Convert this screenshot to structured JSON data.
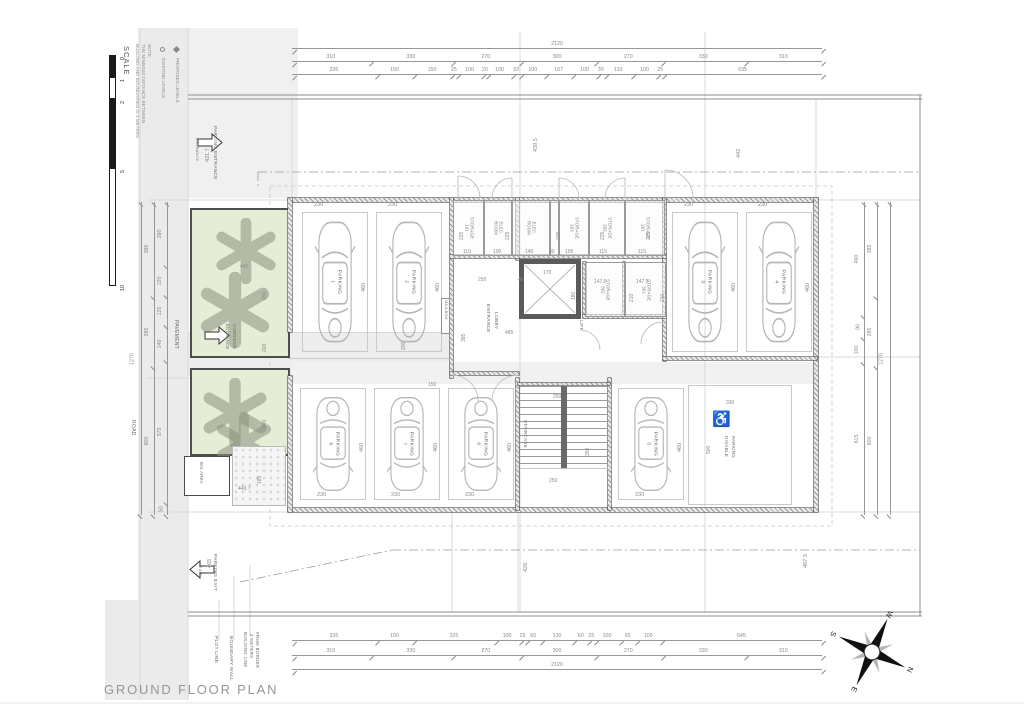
{
  "title": "GROUND FLOOR PLAN",
  "scale": {
    "label": "SCALE",
    "marks": [
      {
        "t": "0",
        "x": 121,
        "y": 60,
        "r": -90
      },
      {
        "t": "1",
        "x": 121,
        "y": 82,
        "r": -90
      },
      {
        "t": "2",
        "x": 121,
        "y": 104,
        "r": -90
      },
      {
        "t": "5",
        "x": 121,
        "y": 173,
        "r": -90
      },
      {
        "t": "10",
        "x": 121,
        "y": 291,
        "r": -90
      }
    ]
  },
  "note_lines": [
    "NOTE:",
    "THE MINIMUM DISTANCE BETWEEN",
    "BUILDING AND BOUNDARIES IS 3 METERS"
  ],
  "legend": {
    "existing": "EXISTING LEVELS",
    "proposed": "PROPOSED LEVELS"
  },
  "labels": {
    "mailbox": "MAILBOX"
  },
  "compass": {
    "n": "N",
    "e": "E",
    "s": "S",
    "w": "W"
  },
  "dims": {
    "top": [
      [
        "2120"
      ],
      [
        "310",
        "330",
        "270",
        "300",
        "270",
        "330",
        "310"
      ],
      [
        "335",
        "150",
        "150",
        "25",
        "100",
        "20",
        "100",
        "33",
        "100",
        "107",
        "100",
        "30",
        "110",
        "100",
        "25",
        "635"
      ]
    ],
    "bottom": [
      [
        "335",
        "150",
        "325",
        "100",
        "25",
        "60",
        "130",
        "60",
        "25",
        "100",
        "65",
        "100",
        "645"
      ],
      [
        "310",
        "330",
        "270",
        "300",
        "270",
        "330",
        "310"
      ],
      [
        "2120"
      ]
    ],
    "left": [
      [
        "1270"
      ],
      [
        "385",
        "285",
        "600"
      ],
      [
        "260",
        "120",
        "125",
        "140",
        "575",
        "50"
      ]
    ],
    "right": [
      [
        "460",
        "90",
        "100",
        "615"
      ],
      [
        "385",
        "285",
        "600"
      ],
      [
        "1270"
      ]
    ]
  },
  "parking": [
    {
      "l": "PARKING",
      "n": "1",
      "x": 302,
      "y": 212,
      "w": 66,
      "h": 140
    },
    {
      "l": "PARKING",
      "n": "2",
      "x": 376,
      "y": 212,
      "w": 66,
      "h": 140
    },
    {
      "l": "PARKING",
      "n": "3",
      "x": 672,
      "y": 212,
      "w": 66,
      "h": 140
    },
    {
      "l": "PARKING",
      "n": "4",
      "x": 746,
      "y": 212,
      "w": 66,
      "h": 140
    },
    {
      "l": "PARKING",
      "n": "8",
      "x": 300,
      "y": 388,
      "w": 66,
      "h": 112,
      "flip": 1
    },
    {
      "l": "PARKING",
      "n": "7",
      "x": 374,
      "y": 388,
      "w": 66,
      "h": 112,
      "flip": 1
    },
    {
      "l": "PARKING",
      "n": "6",
      "x": 448,
      "y": 388,
      "w": 66,
      "h": 112,
      "flip": 1
    },
    {
      "l": "PARKING",
      "n": "5",
      "x": 618,
      "y": 388,
      "w": 66,
      "h": 112,
      "flip": 1
    }
  ],
  "rooms": [
    {
      "l1": "STORAGE",
      "l2": "101",
      "x": 453,
      "y": 200,
      "w": 31,
      "h": 56
    },
    {
      "l1": "ELEC.",
      "l2": "ROOM",
      "x": 484,
      "y": 200,
      "w": 28,
      "h": 56
    },
    {
      "l1": "ELEC.",
      "l2": "ROOM",
      "x": 512,
      "y": 200,
      "w": 38,
      "h": 56
    },
    {
      "l1": "",
      "l2": "",
      "x": 550,
      "y": 200,
      "w": 9,
      "h": 56
    },
    {
      "l1": "STORAGE",
      "l2": "203",
      "x": 559,
      "y": 200,
      "w": 30,
      "h": 56
    },
    {
      "l1": "STORAGE",
      "l2": "202",
      "x": 589,
      "y": 200,
      "w": 36,
      "h": 56
    },
    {
      "l1": "STORAGE",
      "l2": "201",
      "x": 625,
      "y": 200,
      "w": 40,
      "h": 56
    },
    {
      "l1": "STORAGE",
      "l2": "302",
      "x": 585,
      "y": 262,
      "w": 40,
      "h": 55
    },
    {
      "l1": "STORAGE",
      "l2": "301",
      "x": 625,
      "y": 262,
      "w": 41,
      "h": 55
    }
  ],
  "trees": [
    {
      "x": 213,
      "y": 218,
      "w": 66,
      "h": 66
    },
    {
      "x": 197,
      "y": 272,
      "w": 76,
      "h": 76
    },
    {
      "x": 200,
      "y": 378,
      "w": 70,
      "h": 70
    },
    {
      "x": 214,
      "y": 412,
      "w": 60,
      "h": 60
    }
  ],
  "area_labels": [
    {
      "t": "ENTRANCE",
      "x": 489,
      "y": 304,
      "r": 90,
      "fs": 4.8
    },
    {
      "t": "LOBBY",
      "x": 497,
      "y": 312,
      "r": 90,
      "fs": 4.8
    },
    {
      "t": "LIFT",
      "x": 583,
      "y": 320,
      "r": 90,
      "fs": 4.5
    },
    {
      "t": "STAIRCASE",
      "x": 527,
      "y": 420,
      "r": 90,
      "fs": 4.5
    },
    {
      "t": "DISABLE",
      "x": 728,
      "y": 436,
      "r": 90,
      "fs": 4.5
    },
    {
      "t": "PARKING",
      "x": 735,
      "y": 436,
      "r": 90,
      "fs": 4.5
    },
    {
      "t": "BIN AREA",
      "x": 203,
      "y": 462,
      "r": 90,
      "fs": 4.2
    },
    {
      "t": "PAVEMENT",
      "x": 178,
      "y": 320,
      "r": 90,
      "fs": 5
    },
    {
      "t": "ROAD",
      "x": 135,
      "y": 420,
      "r": 90,
      "fs": 5
    },
    {
      "t": "ENTRANCE",
      "x": 229,
      "y": 324,
      "r": 90,
      "fs": 4.2
    },
    {
      "t": "CORRIDOR",
      "x": 236,
      "y": 324,
      "r": 90,
      "fs": 4.2
    },
    {
      "t": "PARKING ENTRANCE",
      "x": 216,
      "y": 126,
      "r": 90,
      "fs": 4.8
    },
    {
      "t": "ENTRANCE",
      "x": 198,
      "y": 138,
      "r": 90,
      "fs": 3.8
    },
    {
      "t": "PARKING EXIT",
      "x": 216,
      "y": 554,
      "r": 90,
      "fs": 4.8
    },
    {
      "t": "EXIT",
      "x": 201,
      "y": 566,
      "r": 90,
      "fs": 3.8
    },
    {
      "t": "PLOT LINE",
      "x": 217,
      "y": 636,
      "r": 90,
      "fs": 4.8
    },
    {
      "t": "BOUNDARY WALL",
      "x": 232,
      "y": 636,
      "r": 90,
      "fs": 4.8
    },
    {
      "t": "BUILDING LINE",
      "x": 247,
      "y": 632,
      "r": 90,
      "fs": 4.4
    },
    {
      "t": "3 METERS",
      "x": 253,
      "y": 634,
      "r": 90,
      "fs": 4.4
    },
    {
      "t": "FROM BORDER",
      "x": 259,
      "y": 632,
      "r": 90,
      "fs": 4.4
    }
  ],
  "dims_free": [
    {
      "t": "230",
      "x": 314,
      "y": 203
    },
    {
      "t": "230",
      "x": 388,
      "y": 203
    },
    {
      "t": "230",
      "x": 684,
      "y": 203
    },
    {
      "t": "230",
      "x": 758,
      "y": 203
    },
    {
      "t": "230",
      "x": 317,
      "y": 493
    },
    {
      "t": "230",
      "x": 391,
      "y": 493
    },
    {
      "t": "230",
      "x": 465,
      "y": 493
    },
    {
      "t": "230",
      "x": 635,
      "y": 493
    },
    {
      "t": "460",
      "x": 362,
      "y": 292,
      "r": -90
    },
    {
      "t": "460",
      "x": 436,
      "y": 292,
      "r": -90
    },
    {
      "t": "460",
      "x": 732,
      "y": 292,
      "r": -90
    },
    {
      "t": "460",
      "x": 806,
      "y": 292,
      "r": -90
    },
    {
      "t": "460",
      "x": 360,
      "y": 452,
      "r": -90
    },
    {
      "t": "460",
      "x": 434,
      "y": 452,
      "r": -90
    },
    {
      "t": "460",
      "x": 508,
      "y": 452,
      "r": -90
    },
    {
      "t": "460",
      "x": 678,
      "y": 452,
      "r": -90
    },
    {
      "t": "110",
      "x": 463,
      "y": 250,
      "fs": 5
    },
    {
      "t": "100",
      "x": 493,
      "y": 250,
      "fs": 5
    },
    {
      "t": "140",
      "x": 525,
      "y": 250,
      "fs": 5
    },
    {
      "t": "30",
      "x": 549,
      "y": 250,
      "fs": 5
    },
    {
      "t": "105",
      "x": 565,
      "y": 250,
      "fs": 5
    },
    {
      "t": "115",
      "x": 599,
      "y": 250,
      "fs": 5
    },
    {
      "t": "115",
      "x": 638,
      "y": 250,
      "fs": 5
    },
    {
      "t": "225",
      "x": 460,
      "y": 240,
      "r": -90,
      "fs": 5
    },
    {
      "t": "225",
      "x": 506,
      "y": 240,
      "r": -90,
      "fs": 5
    },
    {
      "t": "225",
      "x": 557,
      "y": 240,
      "r": -90,
      "fs": 5
    },
    {
      "t": "225",
      "x": 601,
      "y": 240,
      "r": -90,
      "fs": 5
    },
    {
      "t": "225",
      "x": 647,
      "y": 240,
      "r": -90,
      "fs": 5
    },
    {
      "t": "147.5",
      "x": 594,
      "y": 280,
      "fs": 5
    },
    {
      "t": "147.5",
      "x": 636,
      "y": 280,
      "fs": 5
    },
    {
      "t": "210",
      "x": 630,
      "y": 302,
      "r": -90,
      "fs": 5
    },
    {
      "t": "210",
      "x": 661,
      "y": 302,
      "r": -90,
      "fs": 5
    },
    {
      "t": "250",
      "x": 478,
      "y": 278,
      "fs": 5
    },
    {
      "t": "40",
      "x": 518,
      "y": 278,
      "fs": 5
    },
    {
      "t": "170",
      "x": 543,
      "y": 271,
      "fs": 5
    },
    {
      "t": "180",
      "x": 572,
      "y": 300,
      "r": -90,
      "fs": 5
    },
    {
      "t": "385",
      "x": 462,
      "y": 342,
      "r": -90,
      "fs": 5
    },
    {
      "t": "150",
      "x": 428,
      "y": 383,
      "fs": 5
    },
    {
      "t": "200",
      "x": 402,
      "y": 350,
      "r": -90,
      "fs": 5
    },
    {
      "t": "250",
      "x": 553,
      "y": 395,
      "fs": 5
    },
    {
      "t": "250",
      "x": 549,
      "y": 479,
      "fs": 5
    },
    {
      "t": "350",
      "x": 586,
      "y": 456,
      "r": -90,
      "fs": 5
    },
    {
      "t": "330",
      "x": 726,
      "y": 401,
      "fs": 5
    },
    {
      "t": "500",
      "x": 707,
      "y": 454,
      "r": -90,
      "fs": 5
    },
    {
      "t": "440",
      "x": 240,
      "y": 265,
      "fs": 5
    },
    {
      "t": "450",
      "x": 263,
      "y": 300,
      "r": -90,
      "fs": 5
    },
    {
      "t": "200",
      "x": 263,
      "y": 352,
      "r": -90,
      "fs": 5
    },
    {
      "t": "390",
      "x": 263,
      "y": 428,
      "r": -90,
      "fs": 5
    },
    {
      "t": "185",
      "x": 258,
      "y": 484,
      "r": -90,
      "fs": 5
    },
    {
      "t": "431.7",
      "x": 206,
      "y": 162,
      "r": -90
    },
    {
      "t": "439.5",
      "x": 534,
      "y": 152,
      "r": -90
    },
    {
      "t": "442",
      "x": 737,
      "y": 158,
      "r": -90
    },
    {
      "t": "465",
      "x": 208,
      "y": 568,
      "r": -90
    },
    {
      "t": "426",
      "x": 524,
      "y": 572,
      "r": -90
    },
    {
      "t": "487.3",
      "x": 804,
      "y": 568,
      "r": -90
    },
    {
      "t": "449.7",
      "x": 238,
      "y": 487,
      "fs": 5
    },
    {
      "t": "485",
      "x": 505,
      "y": 331,
      "fs": 5
    }
  ]
}
